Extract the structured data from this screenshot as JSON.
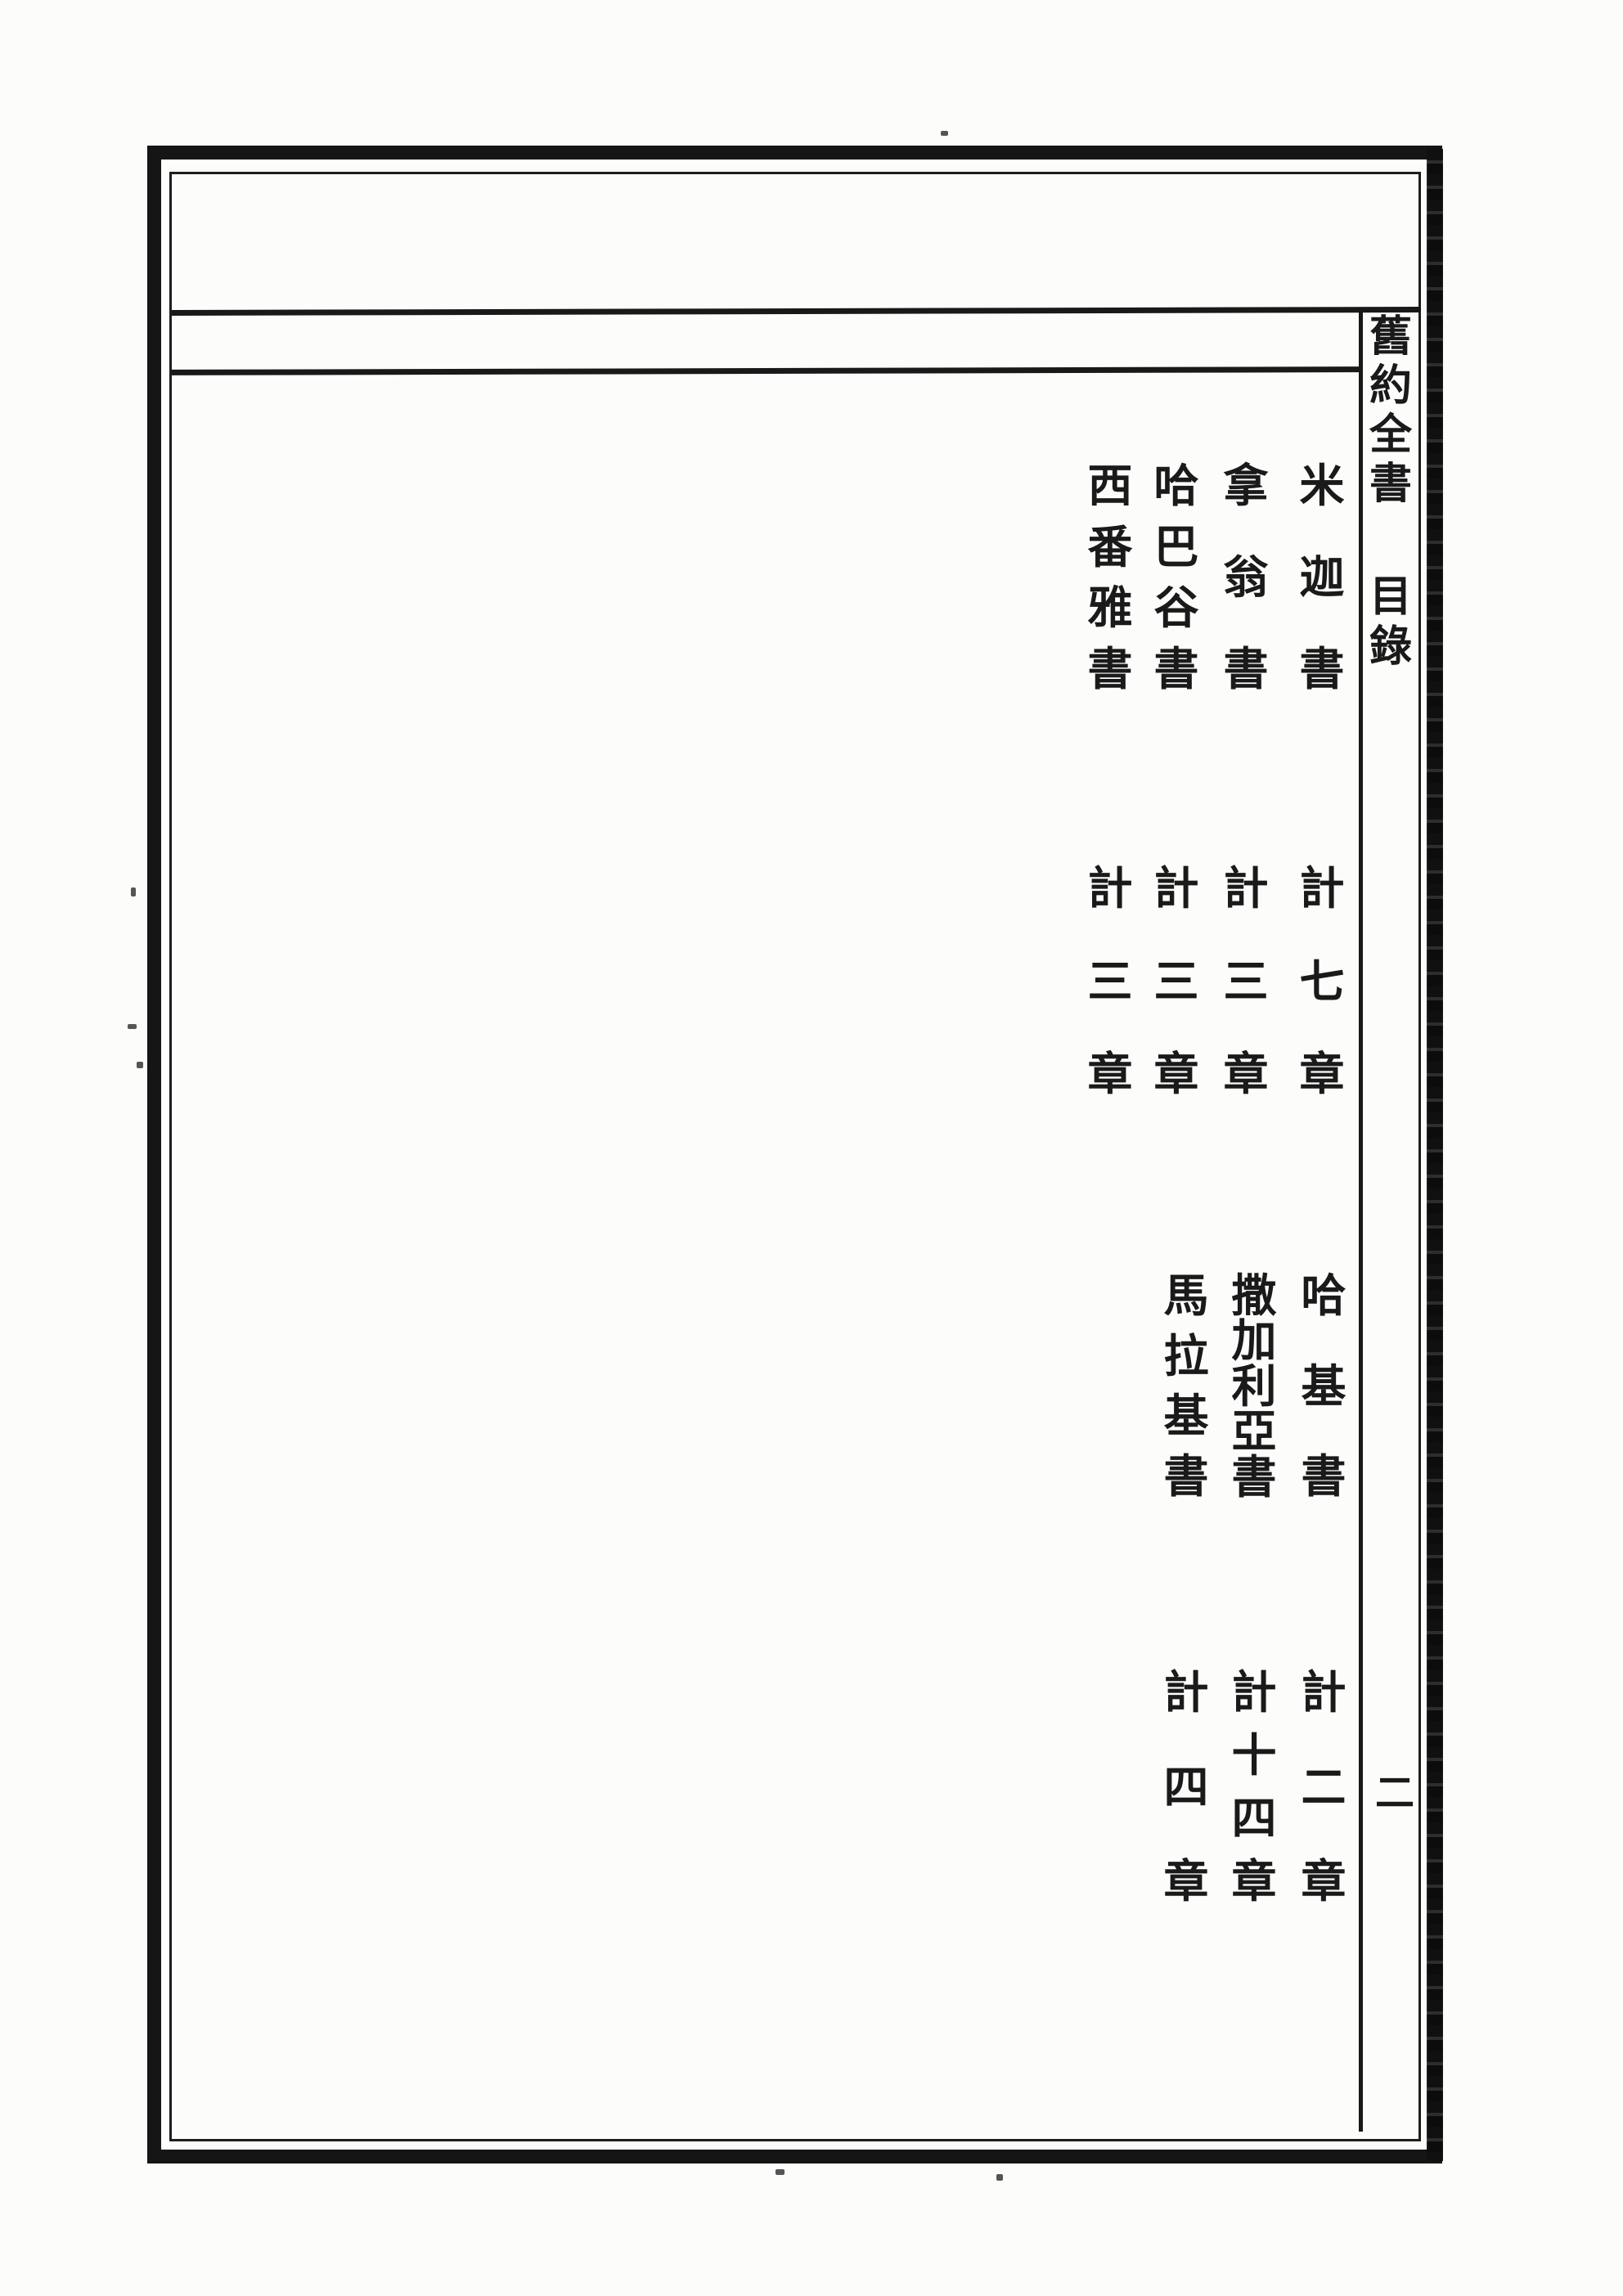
{
  "page": {
    "title": "舊約全書",
    "section_label": "目錄",
    "page_number": "二"
  },
  "toc": {
    "sections": [
      {
        "entries": [
          {
            "book": "米迦書",
            "chapters": "計七章"
          },
          {
            "book": "拿翁書",
            "chapters": "計三章"
          },
          {
            "book": "哈巴谷書",
            "chapters": "計三章"
          },
          {
            "book": "西番雅書",
            "chapters": "計三章"
          }
        ]
      },
      {
        "entries": [
          {
            "book": "哈基書",
            "chapters": "計二章"
          },
          {
            "book": "撒加利亞書",
            "chapters": "計十四章"
          },
          {
            "book": "馬拉基書",
            "chapters": "計四章"
          }
        ]
      }
    ]
  },
  "colors": {
    "ink": "#1a1a1a",
    "paper": "#fcfcfa"
  }
}
